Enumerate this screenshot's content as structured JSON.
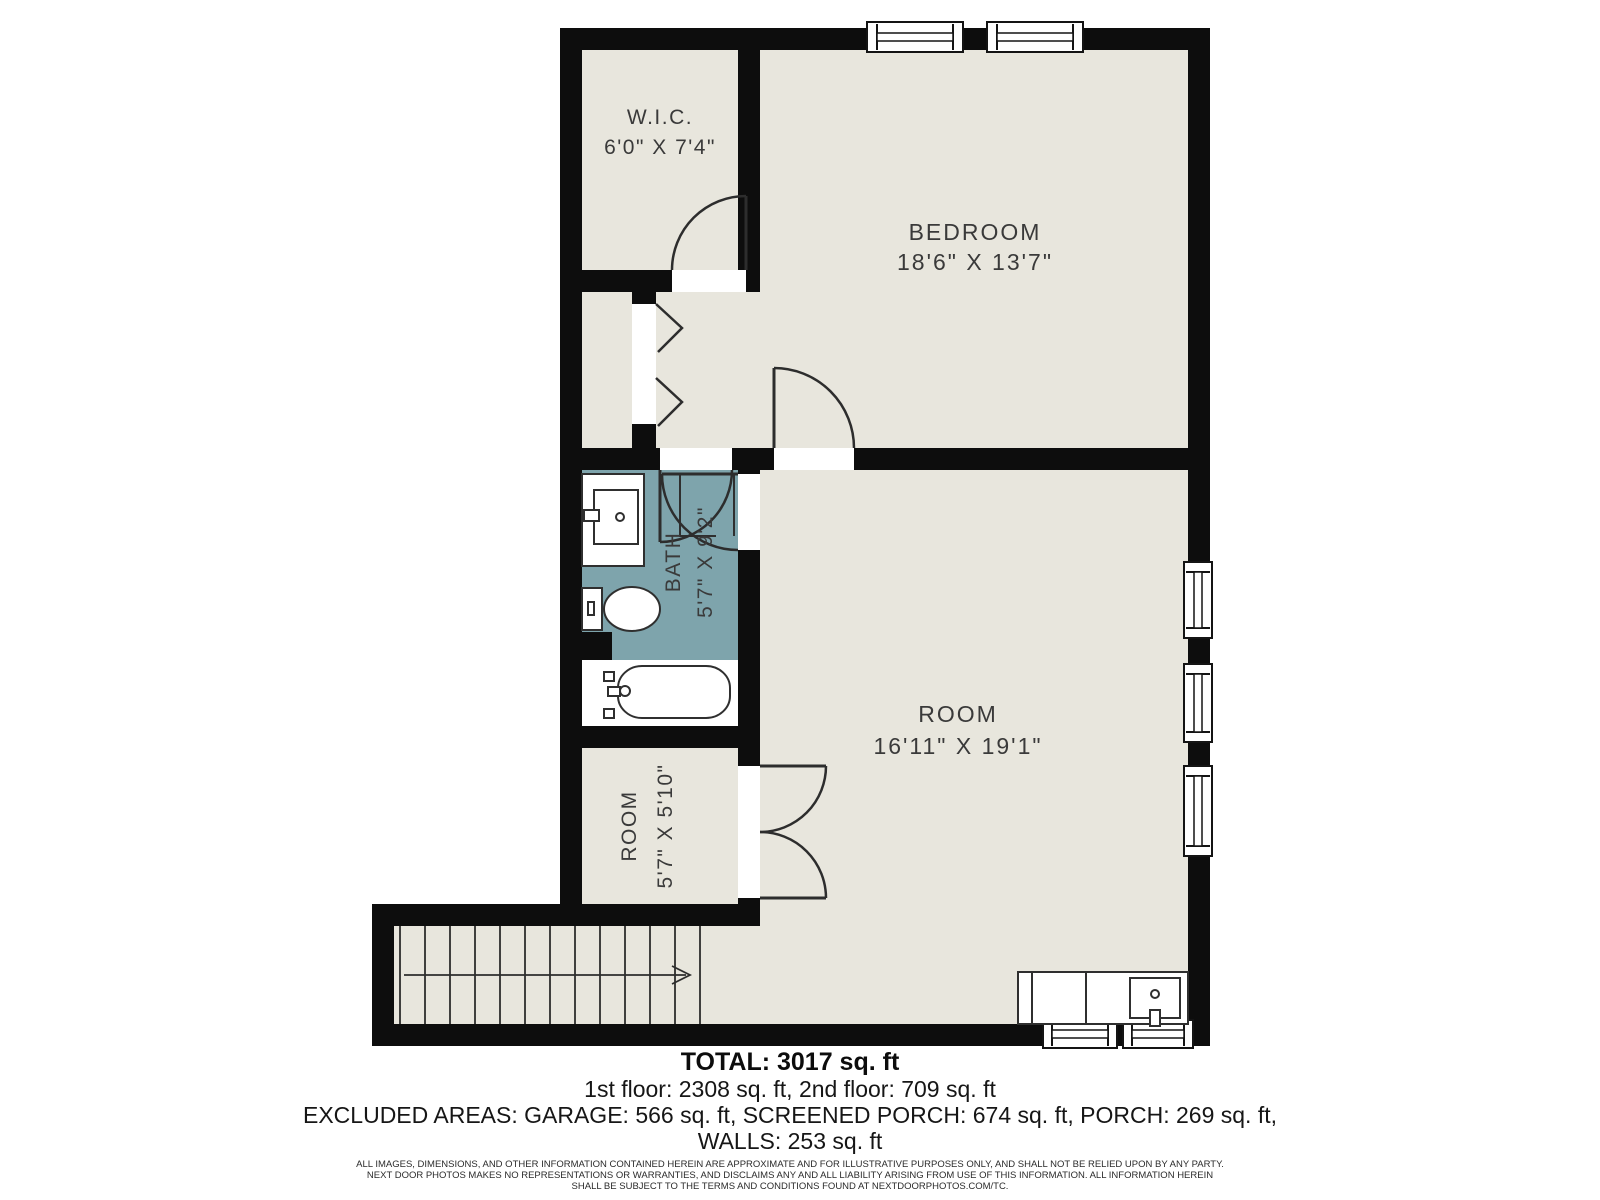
{
  "rooms": [
    {
      "name": "W.I.C.",
      "dims": "6'0\" X 7'4\""
    },
    {
      "name": "BEDROOM",
      "dims": "18'6\" X 13'7\""
    },
    {
      "name": "BATH",
      "dims": "5'7\" X 9'2\""
    },
    {
      "name": "ROOM",
      "dims": "16'11\" X 19'1\""
    },
    {
      "name": "ROOM",
      "dims": "5'7\" X 5'10\""
    }
  ],
  "summary": {
    "total": "TOTAL: 3017 sq. ft",
    "floors": "1st floor: 2308 sq. ft, 2nd floor: 709 sq. ft",
    "excluded": "EXCLUDED AREAS: GARAGE: 566 sq. ft, SCREENED PORCH: 674 sq. ft, PORCH: 269 sq. ft,",
    "walls": "WALLS: 253 sq. ft"
  },
  "disclaimer": {
    "line1": "ALL IMAGES, DIMENSIONS, AND OTHER INFORMATION CONTAINED HEREIN ARE APPROXIMATE AND FOR ILLUSTRATIVE PURPOSES ONLY, AND SHALL NOT BE RELIED UPON BY ANY PARTY.",
    "line2": "NEXT DOOR PHOTOS MAKES NO REPRESENTATIONS OR WARRANTIES, AND DISCLAIMS ANY AND ALL LIABILITY ARISING FROM USE OF THIS INFORMATION. ALL INFORMATION HEREIN",
    "line3": "SHALL BE SUBJECT TO THE TERMS AND CONDITIONS FOUND AT NEXTDOORPHOTOS.COM/TC."
  },
  "colors": {
    "floor": "#e8e6dd",
    "bath": "#7ea4ac",
    "wall": "#0d0d0d",
    "background": "#ffffff"
  }
}
